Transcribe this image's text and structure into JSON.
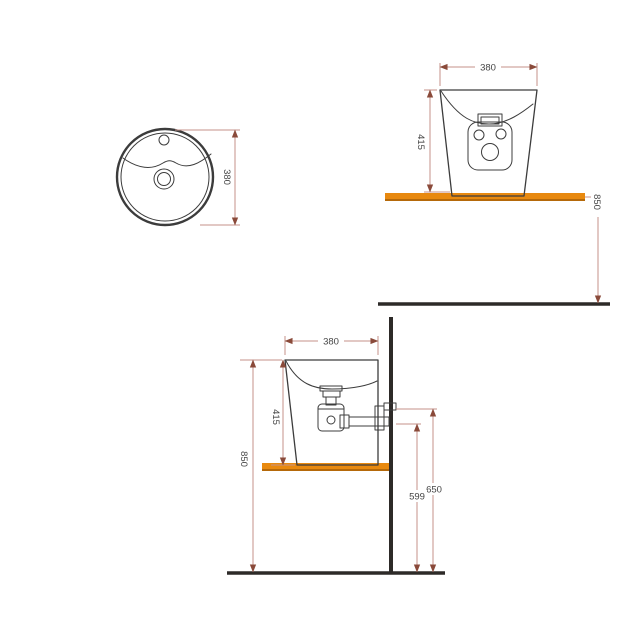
{
  "views": {
    "top_view": {
      "dims": {
        "diameter": "380"
      }
    },
    "front_view": {
      "dims": {
        "width": "380",
        "height": "415",
        "floor_height": "850"
      }
    },
    "side_view": {
      "dims": {
        "width": "380",
        "height": "415",
        "floor_height": "850",
        "drain_outlet_height": "650",
        "drain_center_height": "599"
      }
    }
  },
  "colors": {
    "shelf_orange": "#e8890f",
    "shelf_edge": "#b5690a",
    "outline": "#3c3c3c",
    "wall_floor": "#2d2a28",
    "dimension_line": "#c4928a",
    "dimension_arrow": "#8a4a3a",
    "dimension_text": "#454545"
  }
}
